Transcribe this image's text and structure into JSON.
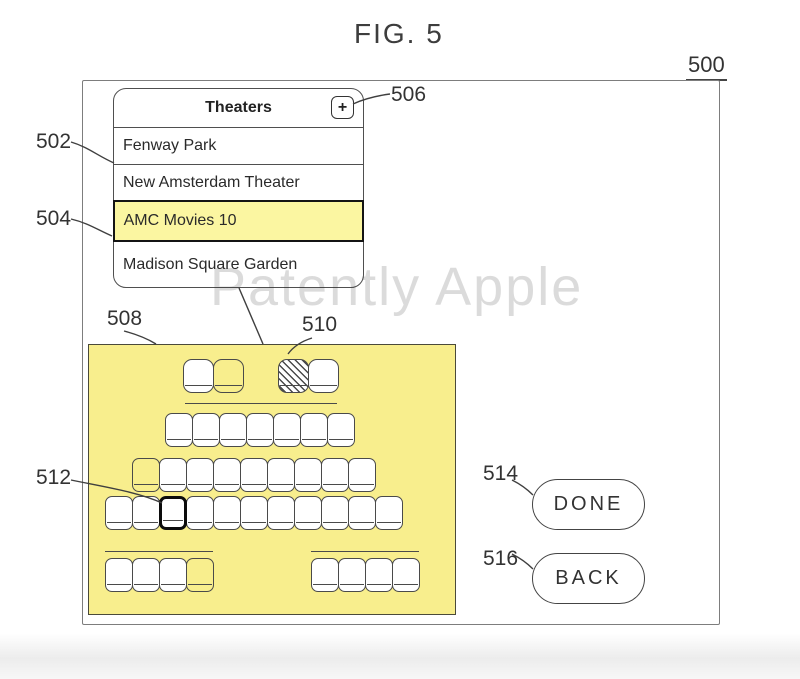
{
  "figure": {
    "title": "FIG. 5",
    "ref_label": "500"
  },
  "watermark": "Patently Apple",
  "theaters_panel": {
    "title": "Theaters",
    "add_button_glyph": "+",
    "items": [
      {
        "label": "Fenway Park",
        "highlighted": false
      },
      {
        "label": "New Amsterdam Theater",
        "highlighted": false
      },
      {
        "label": "AMC Movies 10",
        "highlighted": true
      },
      {
        "label": "Madison Square Garden",
        "highlighted": false
      }
    ]
  },
  "seat_map": {
    "legend": {
      "available": "white seat",
      "vacant": "unfilled seat (background shows through)",
      "occupied": "hatched seat",
      "selected": "thick black outlined seat"
    },
    "rows": {
      "balcony_left": [
        "available",
        "vacant"
      ],
      "balcony_right": [
        "occupied",
        "available"
      ],
      "row_1": [
        "available",
        "available",
        "available",
        "available",
        "available",
        "available",
        "available"
      ],
      "row_2": [
        "vacant",
        "available",
        "available",
        "available",
        "available",
        "available",
        "available",
        "available",
        "available"
      ],
      "row_3": [
        "available",
        "available",
        "selected",
        "available",
        "available",
        "available",
        "available",
        "available",
        "available",
        "available",
        "available"
      ],
      "front_left": [
        "available",
        "available",
        "available",
        "vacant"
      ],
      "front_right": [
        "available",
        "available",
        "available",
        "available"
      ]
    }
  },
  "buttons": {
    "done": "DONE",
    "back": "BACK"
  },
  "ref_numbers": {
    "theater_list": "502",
    "selected_theater": "504",
    "add_button": "506",
    "seat_map": "508",
    "occupied_seat": "510",
    "selected_seat": "512",
    "done_button": "514",
    "back_button": "516"
  },
  "colors": {
    "highlight_yellow": "#fbf6a1",
    "map_yellow": "#f8ee8d"
  }
}
